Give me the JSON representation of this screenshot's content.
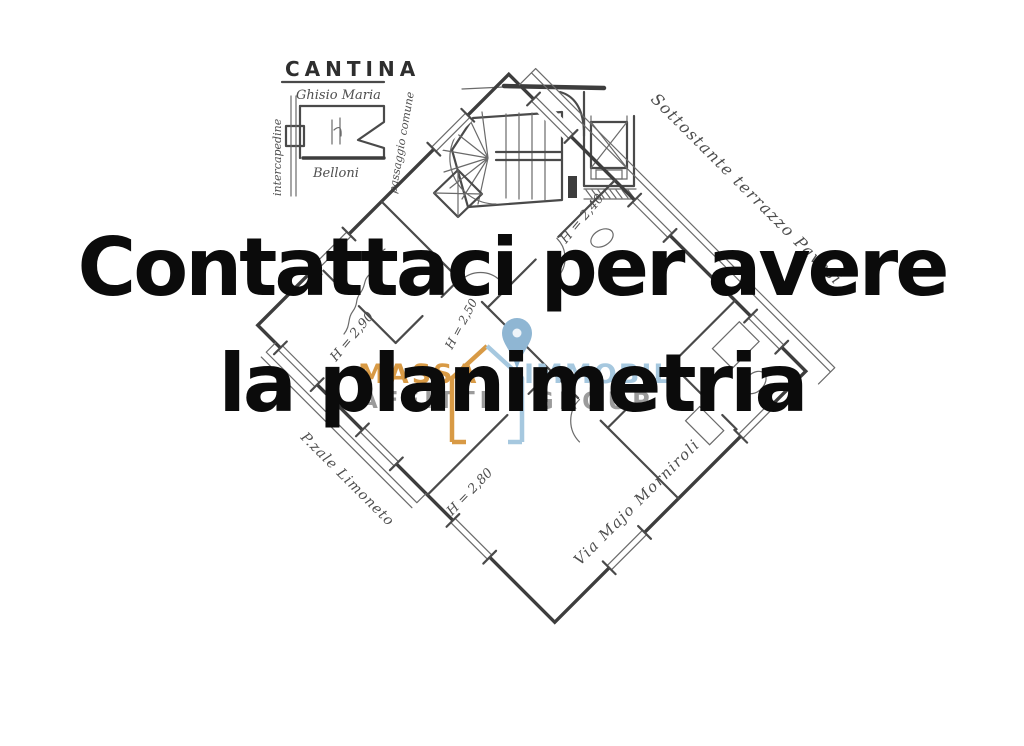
{
  "page": {
    "background": "#ffffff"
  },
  "headline": {
    "line1": "Contattaci per avere",
    "line2": "la planimetria",
    "color": "#0b0b0b"
  },
  "watermark": {
    "brand_top_left": "MASSA",
    "brand_bottom_left": "AFFITTI",
    "brand_top_right": "IMMOBIL",
    "brand_bottom_right": "GROUP",
    "colors": {
      "orange": "#d89a45",
      "light_blue": "#a6c8df",
      "gray": "#9b9b9b",
      "pin_blue": "#8fb6d3"
    }
  },
  "floor_plan": {
    "cantina": {
      "title": "CANTINA",
      "owner_note": "Ghisio Maria",
      "room_note": "Belloni",
      "left_note": "intercapedine",
      "right_note": "passaggio comune"
    },
    "heights": [
      {
        "text": "H = 2,90"
      },
      {
        "text": "H = 2,40"
      },
      {
        "text": "H = 2,50"
      },
      {
        "text": "H = 2,80"
      }
    ],
    "street_notes": {
      "terrace": "Sottostante terrazzo Pavesi",
      "street_right": "Via Majo Morniroli",
      "street_left": "P.zale Limoneto"
    }
  }
}
